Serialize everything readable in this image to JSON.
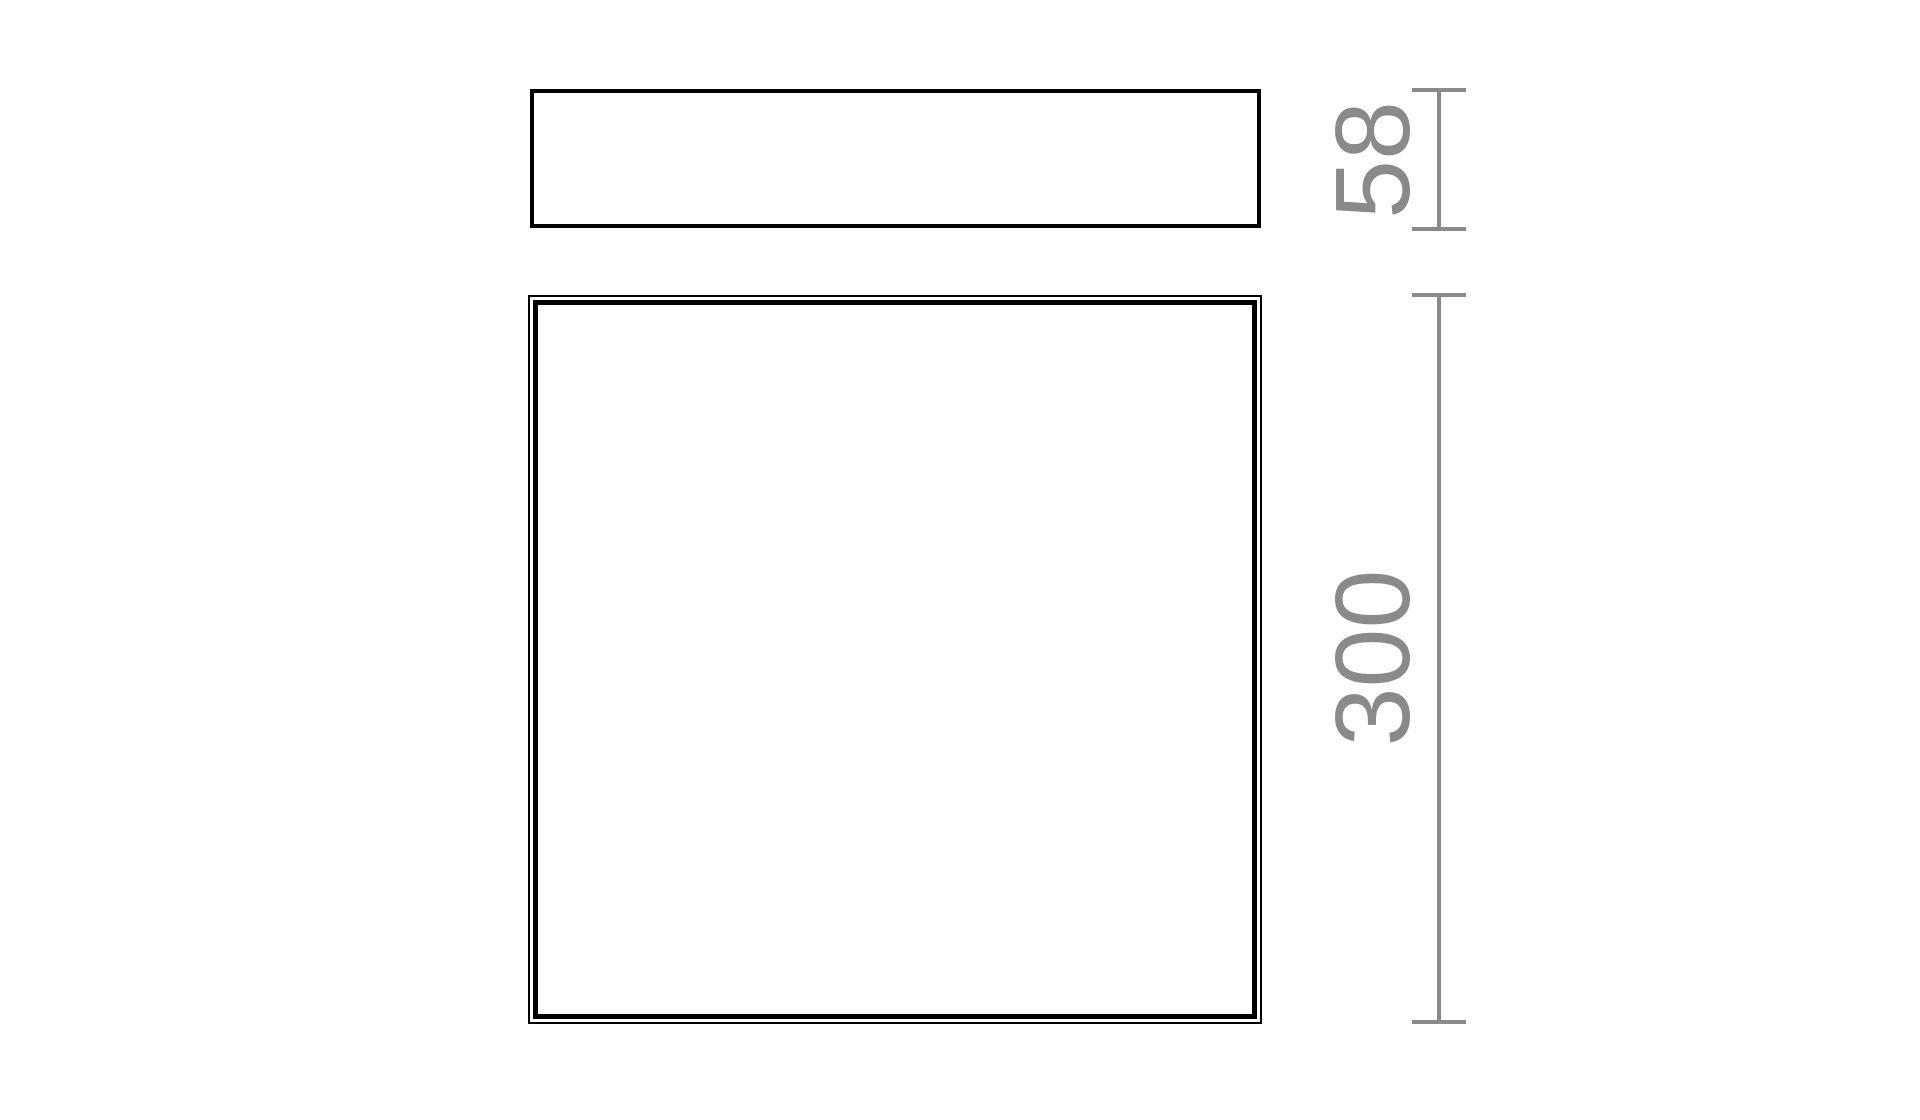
{
  "drawing": {
    "kind": "technical-dimension-drawing",
    "dimensions": {
      "depth": {
        "label": "58"
      },
      "width": {
        "label": "300"
      }
    }
  },
  "colors": {
    "outline": "#000000",
    "dimension": "#8a8a8a",
    "background": "#ffffff"
  }
}
